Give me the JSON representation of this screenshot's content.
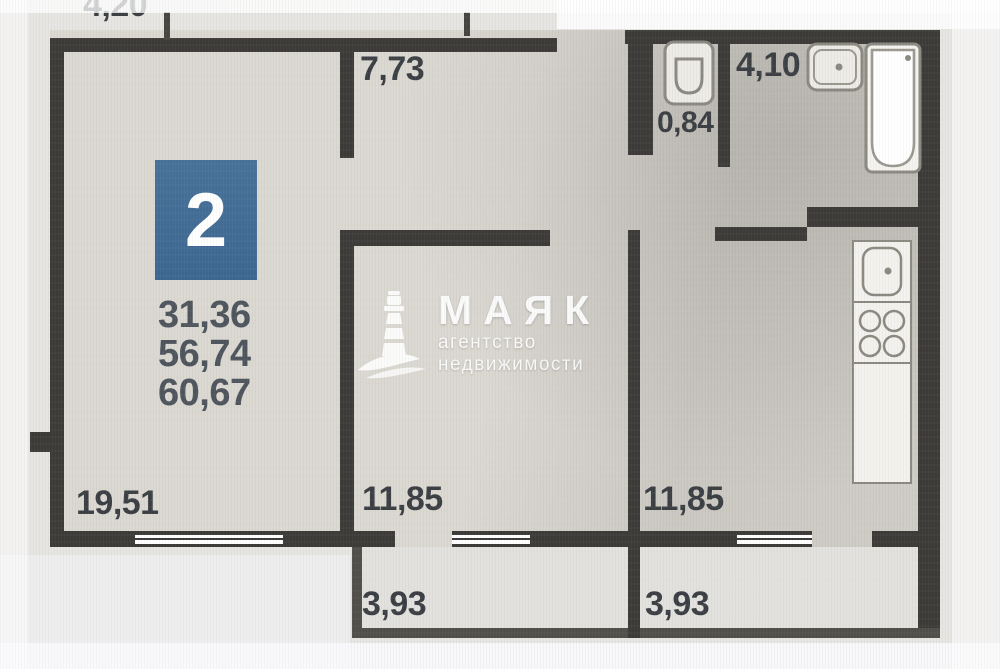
{
  "badge": {
    "value": "2",
    "color": "#3f6a94"
  },
  "area_values": [
    "31,36",
    "56,74",
    "60,67"
  ],
  "dimensions": {
    "top": "4,20"
  },
  "rooms": {
    "hallway": {
      "label": "7,73"
    },
    "wc": {
      "label": "0,84"
    },
    "bathroom": {
      "label": "4,10"
    },
    "living_room": {
      "label": "19,51"
    },
    "bedroom": {
      "label": "11,85"
    },
    "kitchen": {
      "label": "11,85"
    },
    "balcony_left": {
      "label": "3,93"
    },
    "balcony_right": {
      "label": "3,93"
    }
  },
  "watermark": {
    "brand": "МАЯК",
    "tagline": "агентство недвижимости"
  },
  "colors": {
    "wall": "#3b3a37",
    "floor": "#dbd8d1",
    "badge_blue": "#3f6a94",
    "label_text": "#3a3e42",
    "values_text": "#4d545c"
  }
}
